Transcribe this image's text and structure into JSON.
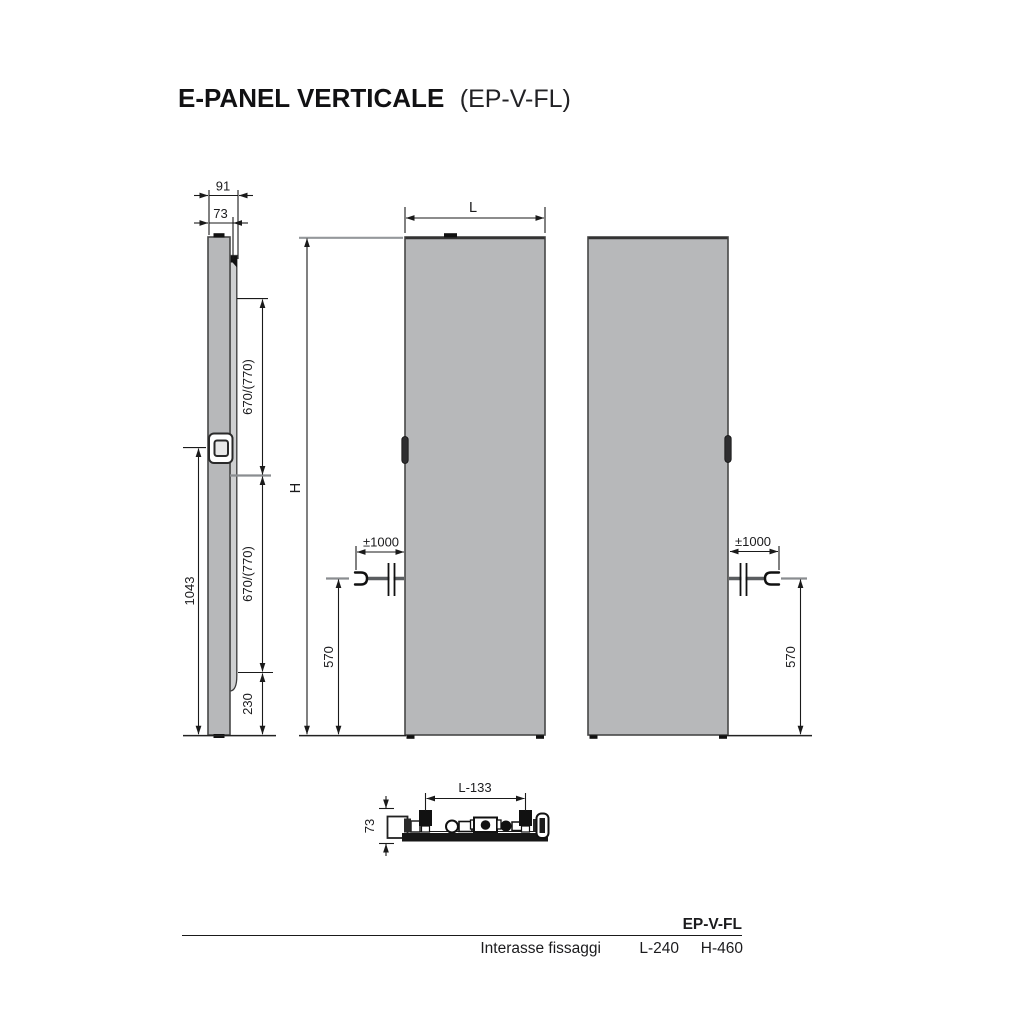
{
  "title": {
    "main": "E-PANEL VERTICALE",
    "code": "(EP-V-FL)"
  },
  "colors": {
    "panel_fill": "#b7b8ba",
    "line": "#1a1a1a"
  },
  "side_view": {
    "depth_total": "91",
    "depth_panel": "73",
    "height_to_bracket": "1043",
    "span_upper": "670/(770)",
    "span_lower": "670/(770)",
    "bottom_offset": "230"
  },
  "front_view": {
    "width_label": "L",
    "height_label": "H",
    "cable_allowance": "±1000",
    "cable_height": "570"
  },
  "right_view": {
    "cable_allowance": "±1000",
    "cable_height": "570"
  },
  "bottom_view": {
    "fixing_span": "L-133",
    "depth": "73"
  },
  "spec_table": {
    "model": "EP-V-FL",
    "row_label": "Interasse fissaggi",
    "l_spacing": "L-240",
    "h_spacing": "H-460"
  }
}
